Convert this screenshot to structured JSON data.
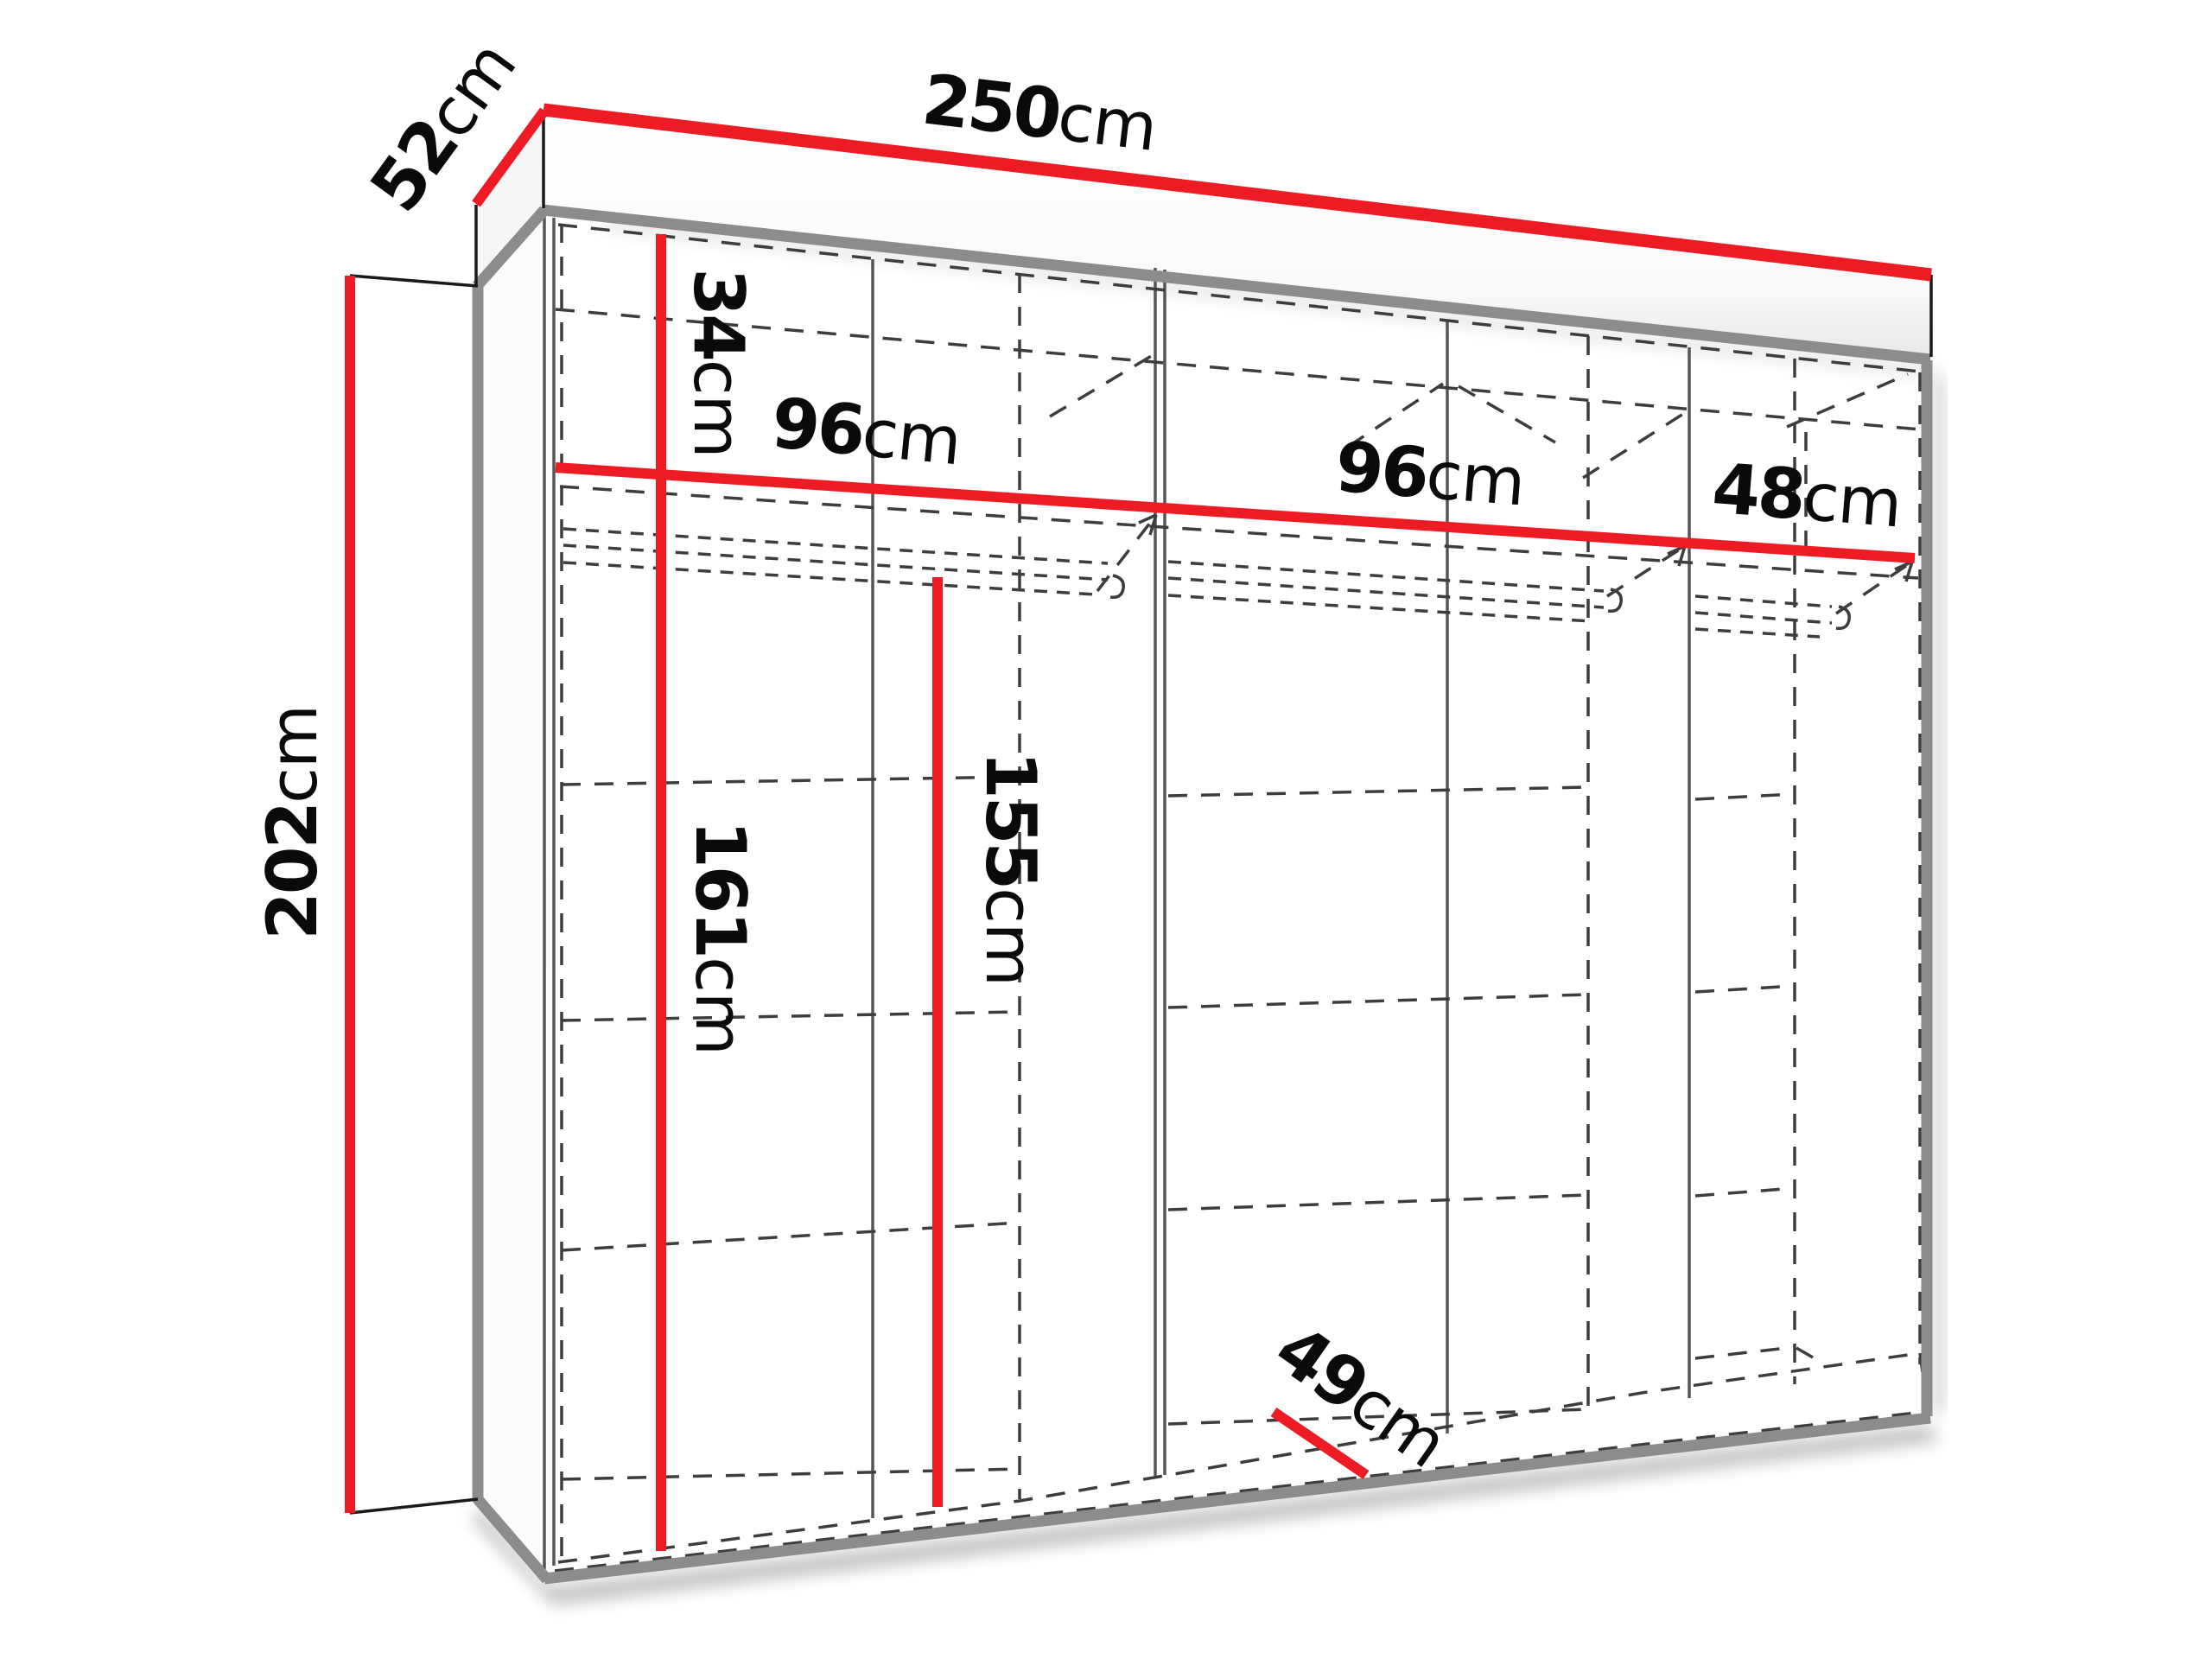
{
  "title": "Wardrobe dimensions diagram",
  "colors": {
    "dimension_red": "#ED1C24",
    "edge_gray": "#8C8C8C",
    "line_dark": "#3d3d3d",
    "text": "#0a0a0a",
    "background": "#ffffff"
  },
  "dimensions": {
    "width": {
      "value": "250",
      "unit": "cm"
    },
    "depth": {
      "value": "52",
      "unit": "cm"
    },
    "height": {
      "value": "202",
      "unit": "cm"
    },
    "top_shelf": {
      "value": "34",
      "unit": "cm"
    },
    "section_left": {
      "value": "96",
      "unit": "cm"
    },
    "section_middle": {
      "value": "96",
      "unit": "cm"
    },
    "section_right": {
      "value": "48",
      "unit": "cm"
    },
    "interior_left_height": {
      "value": "161",
      "unit": "cm"
    },
    "hanging_height": {
      "value": "155",
      "unit": "cm"
    },
    "interior_depth": {
      "value": "49",
      "unit": "cm"
    }
  }
}
